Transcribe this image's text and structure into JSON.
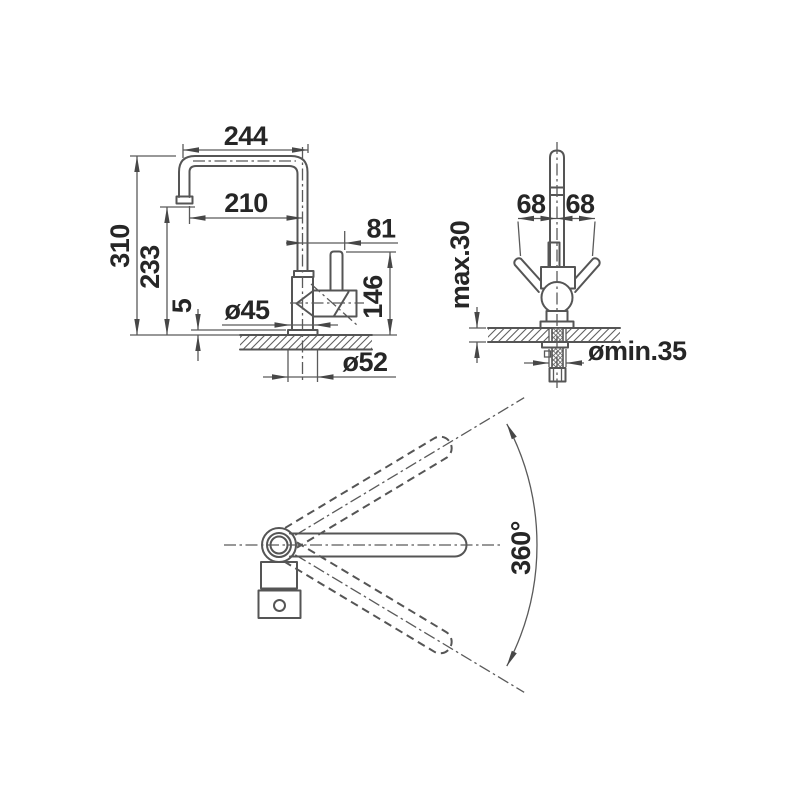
{
  "side_view": {
    "width_top": "244",
    "width_outlet": "210",
    "handle_offset": "81",
    "height_total": "310",
    "height_outlet": "233",
    "base_plate_height": "5",
    "handle_height": "146",
    "dia_body": "ø45",
    "dia_base": "ø52"
  },
  "front_view": {
    "handle_swing_left": "68",
    "handle_swing_right": "68",
    "counter_thickness": "max.30",
    "hole_diameter": "ømin.35"
  },
  "top_view": {
    "swivel_range": "360°"
  },
  "colors": {
    "line": "#555555",
    "text": "#262626",
    "background": "#ffffff"
  }
}
